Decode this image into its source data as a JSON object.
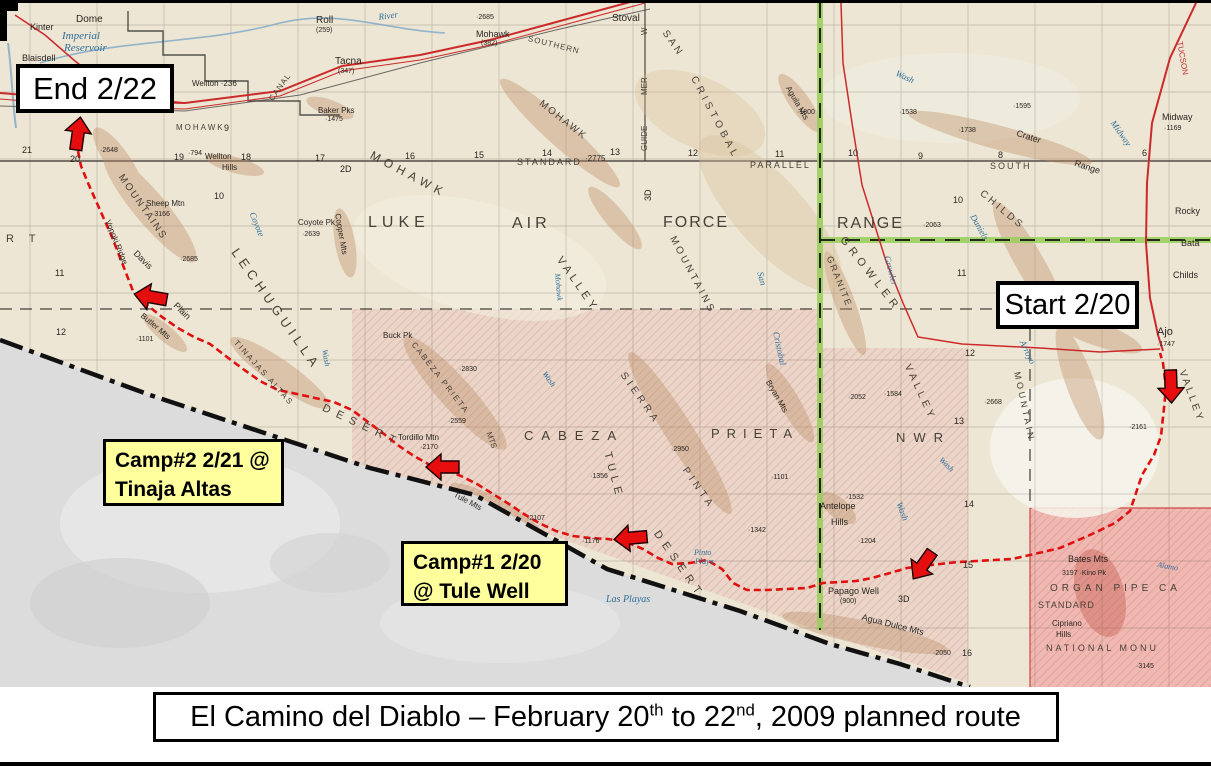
{
  "title": {
    "part1": "El Camino del Diablo – February 20",
    "sup1": "th",
    "part2": " to 22",
    "sup2": "nd",
    "part3": ", 2009 planned route"
  },
  "annotations": {
    "end_label": "End 2/22",
    "start_label": "Start 2/20",
    "camp2_line1": "Camp#2 2/21 @",
    "camp2_line2": "Tinaja Altas",
    "camp1_line1": "Camp#1 2/20",
    "camp1_line2": "@ Tule Well"
  },
  "colors": {
    "route_red": "#e01010",
    "arrow_red": "#e50d0d",
    "boundary_green": "#9ccf5f",
    "camp_yellow": "#ffff9e",
    "map_cream": "#ede6d4",
    "nwr_pink": "#e9d2c6",
    "organ_pipe_pink": "#f0b6b0",
    "mexico_gray": "#dcdcdc",
    "water_blue": "#2e6e99"
  },
  "route": {
    "points": [
      [
        78,
        148
      ],
      [
        81,
        163
      ],
      [
        88,
        180
      ],
      [
        96,
        198
      ],
      [
        104,
        216
      ],
      [
        112,
        234
      ],
      [
        119,
        252
      ],
      [
        126,
        270
      ],
      [
        133,
        288
      ],
      [
        146,
        301
      ],
      [
        162,
        314
      ],
      [
        178,
        325
      ],
      [
        194,
        334
      ],
      [
        210,
        341
      ],
      [
        227,
        354
      ],
      [
        243,
        366
      ],
      [
        260,
        378
      ],
      [
        278,
        387
      ],
      [
        297,
        391
      ],
      [
        315,
        395
      ],
      [
        334,
        399
      ],
      [
        352,
        407
      ],
      [
        368,
        419
      ],
      [
        384,
        431
      ],
      [
        399,
        443
      ],
      [
        414,
        453
      ],
      [
        430,
        462
      ],
      [
        446,
        467
      ],
      [
        461,
        473
      ],
      [
        477,
        481
      ],
      [
        493,
        491
      ],
      [
        509,
        501
      ],
      [
        524,
        511
      ],
      [
        539,
        520
      ],
      [
        556,
        528
      ],
      [
        573,
        533
      ],
      [
        590,
        535
      ],
      [
        608,
        536
      ],
      [
        626,
        539
      ],
      [
        643,
        546
      ],
      [
        658,
        555
      ],
      [
        672,
        561
      ],
      [
        690,
        560
      ],
      [
        707,
        557
      ],
      [
        722,
        566
      ],
      [
        733,
        580
      ],
      [
        747,
        587
      ],
      [
        767,
        587
      ],
      [
        787,
        586
      ],
      [
        807,
        585
      ],
      [
        823,
        580
      ],
      [
        840,
        579
      ],
      [
        856,
        578
      ],
      [
        872,
        575
      ],
      [
        890,
        570
      ],
      [
        907,
        565
      ],
      [
        922,
        563
      ],
      [
        940,
        561
      ],
      [
        958,
        559
      ],
      [
        976,
        558
      ],
      [
        994,
        557
      ],
      [
        1012,
        556
      ],
      [
        1030,
        552
      ],
      [
        1060,
        545
      ],
      [
        1090,
        532
      ],
      [
        1115,
        520
      ],
      [
        1130,
        508
      ],
      [
        1142,
        472
      ],
      [
        1154,
        452
      ],
      [
        1161,
        433
      ],
      [
        1164,
        405
      ],
      [
        1166,
        385
      ],
      [
        1163,
        360
      ],
      [
        1160,
        350
      ]
    ],
    "arrows": [
      {
        "x": 78,
        "y": 131,
        "rot": 8
      },
      {
        "x": 151,
        "y": 294,
        "rot": -80
      },
      {
        "x": 443,
        "y": 464,
        "rot": -90
      },
      {
        "x": 631,
        "y": 535,
        "rot": -95
      },
      {
        "x": 923,
        "y": 562,
        "rot": -145
      },
      {
        "x": 1171,
        "y": 383,
        "rot": 178
      }
    ]
  },
  "map_labels": [
    {
      "t": "LUKE",
      "x": 368,
      "y": 212,
      "s": 16,
      "ls": 5,
      "c": "g"
    },
    {
      "t": "AIR",
      "x": 512,
      "y": 213,
      "s": 16,
      "ls": 4,
      "c": "g"
    },
    {
      "t": "FORCE",
      "x": 663,
      "y": 212,
      "s": 16,
      "ls": 2,
      "c": "g"
    },
    {
      "t": "RANGE",
      "x": 837,
      "y": 213,
      "s": 16,
      "ls": 2,
      "c": "g"
    },
    {
      "t": "CABEZA",
      "x": 524,
      "y": 426,
      "s": 13,
      "ls": 8,
      "c": "g"
    },
    {
      "t": "PRIETA",
      "x": 711,
      "y": 424,
      "s": 13,
      "ls": 7,
      "c": "g"
    },
    {
      "t": "NWR",
      "x": 896,
      "y": 428,
      "s": 13,
      "ls": 8,
      "c": "g"
    },
    {
      "t": "MOHAWK",
      "x": 374,
      "y": 146,
      "s": 12,
      "ls": 5,
      "rot": 28,
      "c": "g"
    },
    {
      "t": "MOHAWK",
      "x": 543,
      "y": 96,
      "s": 10,
      "ls": 2,
      "rot": 38,
      "c": "g"
    },
    {
      "t": "MOUNTAINS",
      "x": 676,
      "y": 232,
      "s": 10,
      "ls": 3,
      "rot": 62,
      "c": "g"
    },
    {
      "t": "VALLEY",
      "x": 563,
      "y": 252,
      "s": 11,
      "ls": 4,
      "rot": 55,
      "c": "g"
    },
    {
      "t": "SAN",
      "x": 668,
      "y": 26,
      "s": 10,
      "ls": 3,
      "rot": 55,
      "c": "g"
    },
    {
      "t": "CRISTOBAL",
      "x": 697,
      "y": 72,
      "s": 10,
      "ls": 4,
      "rot": 62,
      "c": "g"
    },
    {
      "t": "San",
      "x": 764,
      "y": 268,
      "s": 9,
      "rot": 75,
      "c": "b"
    },
    {
      "t": "Cristobal",
      "x": 780,
      "y": 328,
      "s": 9,
      "rot": 78,
      "c": "b"
    },
    {
      "t": "GROWLER",
      "x": 846,
      "y": 232,
      "s": 11,
      "ls": 5,
      "rot": 52,
      "c": "g"
    },
    {
      "t": "Growler",
      "x": 891,
      "y": 252,
      "s": 9,
      "rot": 75,
      "c": "b"
    },
    {
      "t": "GRANITE",
      "x": 833,
      "y": 252,
      "s": 9,
      "ls": 2,
      "rot": 68,
      "c": "g"
    },
    {
      "t": "CHILDS",
      "x": 984,
      "y": 186,
      "s": 10,
      "ls": 3,
      "rot": 40,
      "c": "g"
    },
    {
      "t": "Daniels",
      "x": 976,
      "y": 210,
      "s": 9,
      "rot": 60,
      "c": "b"
    },
    {
      "t": "VALLEY",
      "x": 911,
      "y": 360,
      "s": 10,
      "ls": 4,
      "rot": 65,
      "c": "g"
    },
    {
      "t": "VALLEY",
      "x": 1186,
      "y": 366,
      "s": 10,
      "ls": 3,
      "rot": 70,
      "c": "g"
    },
    {
      "t": "MOUNTAIN",
      "x": 1021,
      "y": 368,
      "s": 9,
      "ls": 3,
      "rot": 78,
      "c": "g"
    },
    {
      "t": "Arroyo",
      "x": 1026,
      "y": 336,
      "s": 9,
      "rot": 65,
      "c": "b"
    },
    {
      "t": "LECHUGUILLA",
      "x": 240,
      "y": 243,
      "s": 13,
      "ls": 5,
      "rot": 55,
      "c": "g"
    },
    {
      "t": "DESERT",
      "x": 325,
      "y": 400,
      "s": 11,
      "ls": 7,
      "rot": 25,
      "c": "g"
    },
    {
      "t": "DESERT",
      "x": 660,
      "y": 526,
      "s": 11,
      "ls": 6,
      "rot": 55,
      "c": "g"
    },
    {
      "t": "R T",
      "x": 6,
      "y": 231,
      "s": 11,
      "ls": 6,
      "c": "g"
    },
    {
      "t": "MOUNTAINS",
      "x": 124,
      "y": 170,
      "s": 10,
      "ls": 2,
      "rot": 55,
      "c": "g"
    },
    {
      "t": "Vopoki Ridge",
      "x": 111,
      "y": 216,
      "s": 8,
      "rot": 68
    },
    {
      "t": "Davis",
      "x": 138,
      "y": 246,
      "s": 9,
      "rot": 45
    },
    {
      "t": "Plain",
      "x": 178,
      "y": 298,
      "s": 9,
      "rot": 45
    },
    {
      "t": "Butler Mts",
      "x": 144,
      "y": 309,
      "s": 8,
      "rot": 40
    },
    {
      "t": "TINAJAS ALTAS",
      "x": 238,
      "y": 336,
      "s": 8,
      "ls": 2,
      "rot": 48,
      "c": "g"
    },
    {
      "t": "CABEZA PRIETA",
      "x": 416,
      "y": 338,
      "s": 8,
      "ls": 2,
      "rot": 52,
      "c": "g"
    },
    {
      "t": "MTS",
      "x": 492,
      "y": 428,
      "s": 8,
      "rot": 70,
      "c": "g"
    },
    {
      "t": "SIERRA",
      "x": 626,
      "y": 368,
      "s": 10,
      "ls": 4,
      "rot": 55,
      "c": "g"
    },
    {
      "t": "PINTA",
      "x": 688,
      "y": 463,
      "s": 10,
      "ls": 4,
      "rot": 55,
      "c": "g"
    },
    {
      "t": "TULE",
      "x": 612,
      "y": 448,
      "s": 11,
      "ls": 5,
      "rot": 75,
      "c": "g"
    },
    {
      "t": "Tule Mts",
      "x": 456,
      "y": 488,
      "s": 8,
      "rot": 28
    },
    {
      "t": "Crater",
      "x": 1018,
      "y": 126,
      "s": 9,
      "rot": 18
    },
    {
      "t": "Range",
      "x": 1076,
      "y": 156,
      "s": 9,
      "rot": 18
    },
    {
      "t": "Aguila Mts",
      "x": 791,
      "y": 82,
      "s": 8,
      "rot": 60
    },
    {
      "t": "Agua Dulce Mts",
      "x": 863,
      "y": 610,
      "s": 9,
      "rot": 14
    },
    {
      "t": "Bryan Mts",
      "x": 771,
      "y": 376,
      "s": 8,
      "rot": 60
    },
    {
      "t": "Copper Mts",
      "x": 341,
      "y": 210,
      "s": 8,
      "rot": 80
    },
    {
      "t": "Sheep Mtn",
      "x": 146,
      "y": 197,
      "s": 8
    },
    {
      "t": "·3166",
      "x": 152,
      "y": 208,
      "s": 7
    },
    {
      "t": "Coyote Pk",
      "x": 298,
      "y": 216,
      "s": 8
    },
    {
      "t": "·2639",
      "x": 302,
      "y": 228,
      "s": 7
    },
    {
      "t": "Coyote",
      "x": 256,
      "y": 208,
      "s": 9,
      "rot": 68,
      "c": "b"
    },
    {
      "t": "Wash",
      "x": 328,
      "y": 346,
      "s": 8,
      "rot": 80,
      "c": "b"
    },
    {
      "t": "Wash",
      "x": 547,
      "y": 367,
      "s": 8,
      "rot": 55,
      "c": "b"
    },
    {
      "t": "Wash",
      "x": 898,
      "y": 66,
      "s": 9,
      "rot": 25,
      "c": "b"
    },
    {
      "t": "Wash",
      "x": 943,
      "y": 453,
      "s": 8,
      "rot": 45,
      "c": "b"
    },
    {
      "t": "Wash",
      "x": 903,
      "y": 498,
      "s": 9,
      "rot": 70,
      "c": "b"
    },
    {
      "t": "Mohawk",
      "x": 561,
      "y": 270,
      "s": 8,
      "rot": 85,
      "c": "b"
    },
    {
      "t": "Midway",
      "x": 1116,
      "y": 116,
      "s": 9,
      "rot": 55,
      "c": "b"
    },
    {
      "t": "Imperial",
      "x": 62,
      "y": 28,
      "s": 11,
      "c": "b"
    },
    {
      "t": "Reservoir",
      "x": 64,
      "y": 40,
      "s": 11,
      "c": "b"
    },
    {
      "t": "River",
      "x": 378,
      "y": 10,
      "s": 9,
      "rot": -8,
      "c": "b"
    },
    {
      "t": "Pinto",
      "x": 694,
      "y": 546,
      "s": 8,
      "c": "b"
    },
    {
      "t": "Playa",
      "x": 695,
      "y": 555,
      "s": 8,
      "c": "b"
    },
    {
      "t": "Las Playas",
      "x": 606,
      "y": 592,
      "s": 10,
      "c": "b"
    },
    {
      "t": "Alamo",
      "x": 1158,
      "y": 558,
      "s": 8,
      "rot": 10,
      "c": "b"
    },
    {
      "t": "Kinter",
      "x": 30,
      "y": 20,
      "s": 9
    },
    {
      "t": "Dome",
      "x": 76,
      "y": 12,
      "s": 10
    },
    {
      "t": "Blaisdell",
      "x": 22,
      "y": 51,
      "s": 9
    },
    {
      "t": "Roll",
      "x": 316,
      "y": 13,
      "s": 10
    },
    {
      "t": "(259)",
      "x": 316,
      "y": 24,
      "s": 7
    },
    {
      "t": "Tacna",
      "x": 335,
      "y": 54,
      "s": 10
    },
    {
      "t": "(347)",
      "x": 338,
      "y": 65,
      "s": 7
    },
    {
      "t": "Baker Pks",
      "x": 318,
      "y": 104,
      "s": 8
    },
    {
      "t": "·1475",
      "x": 325,
      "y": 113,
      "s": 7
    },
    {
      "t": "Mohawk",
      "x": 476,
      "y": 27,
      "s": 9
    },
    {
      "t": "(382)",
      "x": 481,
      "y": 37,
      "s": 7
    },
    {
      "t": "Stoval",
      "x": 612,
      "y": 11,
      "s": 10
    },
    {
      "t": "SOUTHERN",
      "x": 529,
      "y": 32,
      "s": 8,
      "ls": 1,
      "rot": 14,
      "c": "g"
    },
    {
      "t": "CANAL",
      "x": 268,
      "y": 95,
      "s": 8,
      "ls": 1,
      "rot": -55,
      "c": "g"
    },
    {
      "t": "Wellton ·236",
      "x": 192,
      "y": 77,
      "s": 8
    },
    {
      "t": "MOHAWK",
      "x": 176,
      "y": 121,
      "s": 8,
      "ls": 2,
      "c": "g"
    },
    {
      "t": "9",
      "x": 224,
      "y": 121,
      "s": 9
    },
    {
      "t": "·2648",
      "x": 100,
      "y": 144,
      "s": 7
    },
    {
      "t": "21",
      "x": 22,
      "y": 143,
      "s": 9
    },
    {
      "t": "20",
      "x": 70,
      "y": 152,
      "s": 9
    },
    {
      "t": "19",
      "x": 174,
      "y": 150,
      "s": 9
    },
    {
      "t": "·794",
      "x": 188,
      "y": 147,
      "s": 7
    },
    {
      "t": "Wellton",
      "x": 205,
      "y": 150,
      "s": 8
    },
    {
      "t": "18",
      "x": 241,
      "y": 150,
      "s": 9
    },
    {
      "t": "Hills",
      "x": 222,
      "y": 161,
      "s": 8
    },
    {
      "t": "17",
      "x": 315,
      "y": 151,
      "s": 9
    },
    {
      "t": "2D",
      "x": 340,
      "y": 162,
      "s": 9
    },
    {
      "t": "16",
      "x": 405,
      "y": 149,
      "s": 9
    },
    {
      "t": "15",
      "x": 474,
      "y": 148,
      "s": 9
    },
    {
      "t": "14",
      "x": 542,
      "y": 146,
      "s": 9
    },
    {
      "t": "13",
      "x": 610,
      "y": 145,
      "s": 9
    },
    {
      "t": "12",
      "x": 688,
      "y": 146,
      "s": 9
    },
    {
      "t": "11",
      "x": 775,
      "y": 147,
      "s": 9
    },
    {
      "t": "10",
      "x": 848,
      "y": 146,
      "s": 9
    },
    {
      "t": "9",
      "x": 918,
      "y": 149,
      "s": 9
    },
    {
      "t": "8",
      "x": 998,
      "y": 148,
      "s": 9
    },
    {
      "t": "STANDARD",
      "x": 517,
      "y": 155,
      "s": 9,
      "ls": 2,
      "c": "g"
    },
    {
      "t": "·2775",
      "x": 585,
      "y": 152,
      "s": 8
    },
    {
      "t": "PARALLEL",
      "x": 750,
      "y": 158,
      "s": 9,
      "ls": 2,
      "c": "g"
    },
    {
      "t": "SOUTH",
      "x": 990,
      "y": 159,
      "s": 9,
      "ls": 2,
      "c": "g"
    },
    {
      "t": "GUIDE",
      "x": 641,
      "y": 148,
      "s": 8,
      "rot": -90,
      "c": "g"
    },
    {
      "t": "MER",
      "x": 641,
      "y": 92,
      "s": 8,
      "rot": -90,
      "c": "g"
    },
    {
      "t": "W",
      "x": 641,
      "y": 32,
      "s": 8,
      "rot": -90,
      "c": "g"
    },
    {
      "t": "3D",
      "x": 644,
      "y": 198,
      "s": 9,
      "rot": -90
    },
    {
      "t": "·2685",
      "x": 476,
      "y": 11,
      "s": 7
    },
    {
      "t": "·2063",
      "x": 923,
      "y": 219,
      "s": 7
    },
    {
      "t": "10",
      "x": 953,
      "y": 193,
      "s": 9
    },
    {
      "t": "11",
      "x": 957,
      "y": 266,
      "s": 9
    },
    {
      "t": "12",
      "x": 965,
      "y": 346,
      "s": 9
    },
    {
      "t": "13",
      "x": 954,
      "y": 414,
      "s": 9
    },
    {
      "t": "14",
      "x": 964,
      "y": 497,
      "s": 9
    },
    {
      "t": "15",
      "x": 963,
      "y": 558,
      "s": 9
    },
    {
      "t": "16",
      "x": 962,
      "y": 646,
      "s": 9
    },
    {
      "t": "11",
      "x": 55,
      "y": 266,
      "s": 9
    },
    {
      "t": "12",
      "x": 56,
      "y": 325,
      "s": 9
    },
    {
      "t": "10",
      "x": 214,
      "y": 189,
      "s": 9
    },
    {
      "t": "·1800",
      "x": 797,
      "y": 106,
      "s": 7
    },
    {
      "t": "·1538",
      "x": 899,
      "y": 106,
      "s": 7
    },
    {
      "t": "·1595",
      "x": 1013,
      "y": 100,
      "s": 7
    },
    {
      "t": "·1738",
      "x": 958,
      "y": 124,
      "s": 7
    },
    {
      "t": "Midway",
      "x": 1162,
      "y": 110,
      "s": 9
    },
    {
      "t": "·1169",
      "x": 1164,
      "y": 122,
      "s": 7
    },
    {
      "t": "6",
      "x": 1142,
      "y": 146,
      "s": 9
    },
    {
      "t": "Rocky",
      "x": 1175,
      "y": 204,
      "s": 9
    },
    {
      "t": "Bata",
      "x": 1181,
      "y": 236,
      "s": 9
    },
    {
      "t": "Childs",
      "x": 1173,
      "y": 268,
      "s": 9
    },
    {
      "t": "Ajo",
      "x": 1157,
      "y": 324,
      "s": 11
    },
    {
      "t": "·1747",
      "x": 1157,
      "y": 338,
      "s": 7
    },
    {
      "t": "·2161",
      "x": 1129,
      "y": 421,
      "s": 7
    },
    {
      "t": "·2668",
      "x": 984,
      "y": 396,
      "s": 7
    },
    {
      "t": "Buck Pk",
      "x": 383,
      "y": 329,
      "s": 8
    },
    {
      "t": "·2830",
      "x": 459,
      "y": 363,
      "s": 7
    },
    {
      "t": "·2559",
      "x": 448,
      "y": 415,
      "s": 7
    },
    {
      "t": "Tordillo Mtn",
      "x": 398,
      "y": 431,
      "s": 8
    },
    {
      "t": "·2170",
      "x": 420,
      "y": 441,
      "s": 7
    },
    {
      "t": "·1356",
      "x": 590,
      "y": 470,
      "s": 7
    },
    {
      "t": "·2950",
      "x": 671,
      "y": 443,
      "s": 7
    },
    {
      "t": "·1584",
      "x": 884,
      "y": 388,
      "s": 7
    },
    {
      "t": "·2052",
      "x": 848,
      "y": 391,
      "s": 7
    },
    {
      "t": "·1101",
      "x": 771,
      "y": 471,
      "s": 7
    },
    {
      "t": "·1101",
      "x": 136,
      "y": 333,
      "s": 7
    },
    {
      "t": "·2685",
      "x": 180,
      "y": 253,
      "s": 7
    },
    {
      "t": "·1176",
      "x": 582,
      "y": 535,
      "s": 7
    },
    {
      "t": "·2107",
      "x": 527,
      "y": 512,
      "s": 7
    },
    {
      "t": "·1342",
      "x": 748,
      "y": 524,
      "s": 7
    },
    {
      "t": "Antelope",
      "x": 820,
      "y": 499,
      "s": 9
    },
    {
      "t": "Hills",
      "x": 831,
      "y": 515,
      "s": 9
    },
    {
      "t": "·1532",
      "x": 846,
      "y": 491,
      "s": 7
    },
    {
      "t": "·1204",
      "x": 858,
      "y": 535,
      "s": 7
    },
    {
      "t": "Papago Well",
      "x": 828,
      "y": 584,
      "s": 9
    },
    {
      "t": "(900)",
      "x": 840,
      "y": 595,
      "s": 7
    },
    {
      "t": "3D",
      "x": 898,
      "y": 592,
      "s": 9
    },
    {
      "t": "·2050",
      "x": 933,
      "y": 647,
      "s": 7
    },
    {
      "t": "Bates Mts",
      "x": 1068,
      "y": 552,
      "s": 9
    },
    {
      "t": "3197 ·Kino Pk",
      "x": 1062,
      "y": 567,
      "s": 7
    },
    {
      "t": "ORGAN PIPE CA",
      "x": 1050,
      "y": 581,
      "s": 10,
      "ls": 4,
      "c": "g"
    },
    {
      "t": "STANDARD",
      "x": 1038,
      "y": 598,
      "s": 9,
      "ls": 1,
      "c": "g"
    },
    {
      "t": "Cipriano",
      "x": 1052,
      "y": 617,
      "s": 8
    },
    {
      "t": "Hills",
      "x": 1056,
      "y": 628,
      "s": 8
    },
    {
      "t": "NATIONAL MONU",
      "x": 1046,
      "y": 641,
      "s": 9,
      "ls": 3,
      "c": "g"
    },
    {
      "t": "·3145",
      "x": 1136,
      "y": 660,
      "s": 7
    },
    {
      "t": "TUCSON",
      "x": 1183,
      "y": 38,
      "s": 8,
      "rot": 80,
      "c": "r"
    }
  ]
}
